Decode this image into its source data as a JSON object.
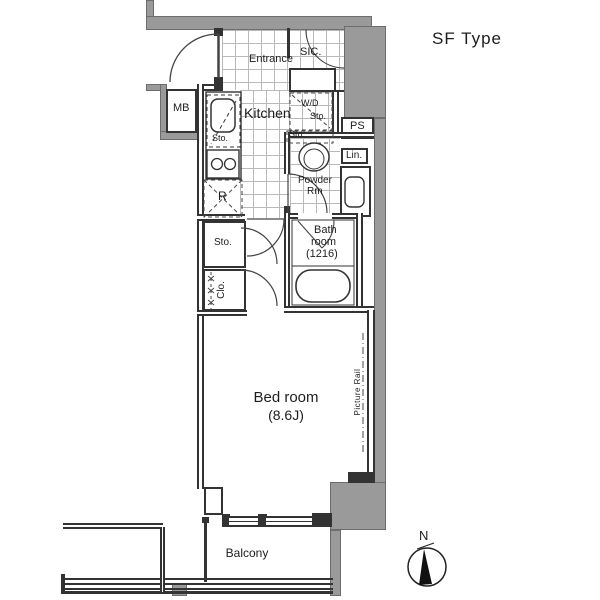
{
  "plan_type_label": "SF Type",
  "compass": {
    "north_label": "N"
  },
  "rooms": {
    "entrance": {
      "label": "Entrance"
    },
    "sic": {
      "label": "SIC."
    },
    "meter_box": {
      "label": "MB"
    },
    "kitchen": {
      "label": "Kitchen"
    },
    "kitchen_storage": {
      "label": "Sto."
    },
    "washer_dryer_storage": {
      "line1": "W/D",
      "line2": "Sto."
    },
    "pipe_space": {
      "label": "PS"
    },
    "linen": {
      "label": "Lin."
    },
    "toilet_storage": {
      "label": "Sto."
    },
    "powder_room": {
      "line1": "Powder",
      "line2": "Rm"
    },
    "refrigerator_space": {
      "label": "R"
    },
    "hall_storage": {
      "label": "Sto."
    },
    "closet": {
      "label": "Clo."
    },
    "bathroom": {
      "line1": "Bath",
      "line2": "room",
      "line3": "(1216)"
    },
    "bedroom": {
      "line1": "Bed room",
      "line2": "(8.6J)"
    },
    "picture_rail": {
      "label": "Picture Rail"
    },
    "balcony": {
      "label": "Balcony"
    }
  },
  "colors": {
    "wall_gray": "#9a9a9a",
    "line": "#333333",
    "tile_line": "#b9b9b9",
    "background": "#ffffff"
  }
}
